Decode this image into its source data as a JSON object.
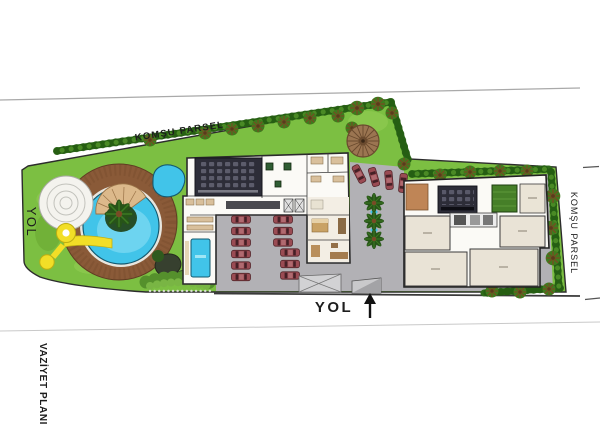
{
  "title": "Vaziyet Planı — architectural site plan",
  "labels": {
    "komsu_parsel_top": "KOMŞU PARSEL",
    "komsu_parsel_right": "KOMŞU PARSEL",
    "yol_left": "YOL",
    "yol_bottom": "YOL",
    "vaziyet_plani": "VAZİYET PLANI"
  },
  "icons": {
    "north_arrow": "up-arrow"
  },
  "colors": {
    "grass": "#7cbf42",
    "grass_light": "#a3d65f",
    "grass_dark": "#5d9a28",
    "hedge": "#2f6b1a",
    "hedge_dot": "#245c12",
    "pavement": "#b2b1b5",
    "water": "#41c4e9",
    "water_light": "#7cd9f1",
    "deck_brown": "#8a5a38",
    "stair_tan": "#dcb98b",
    "slide_yellow": "#f2de27",
    "building_white": "#fbfaf6",
    "room_beige": "#efe9db",
    "wall_dark": "#2b2b2b",
    "cinema_dark": "#2d2d38",
    "car_red": "#9a4b53",
    "gazebo_brown": "#9b7551",
    "table_green": "#2f5d33",
    "turf_green": "#467f28",
    "brown_room": "#bf8556",
    "furniture_brown": "#c9a265"
  }
}
